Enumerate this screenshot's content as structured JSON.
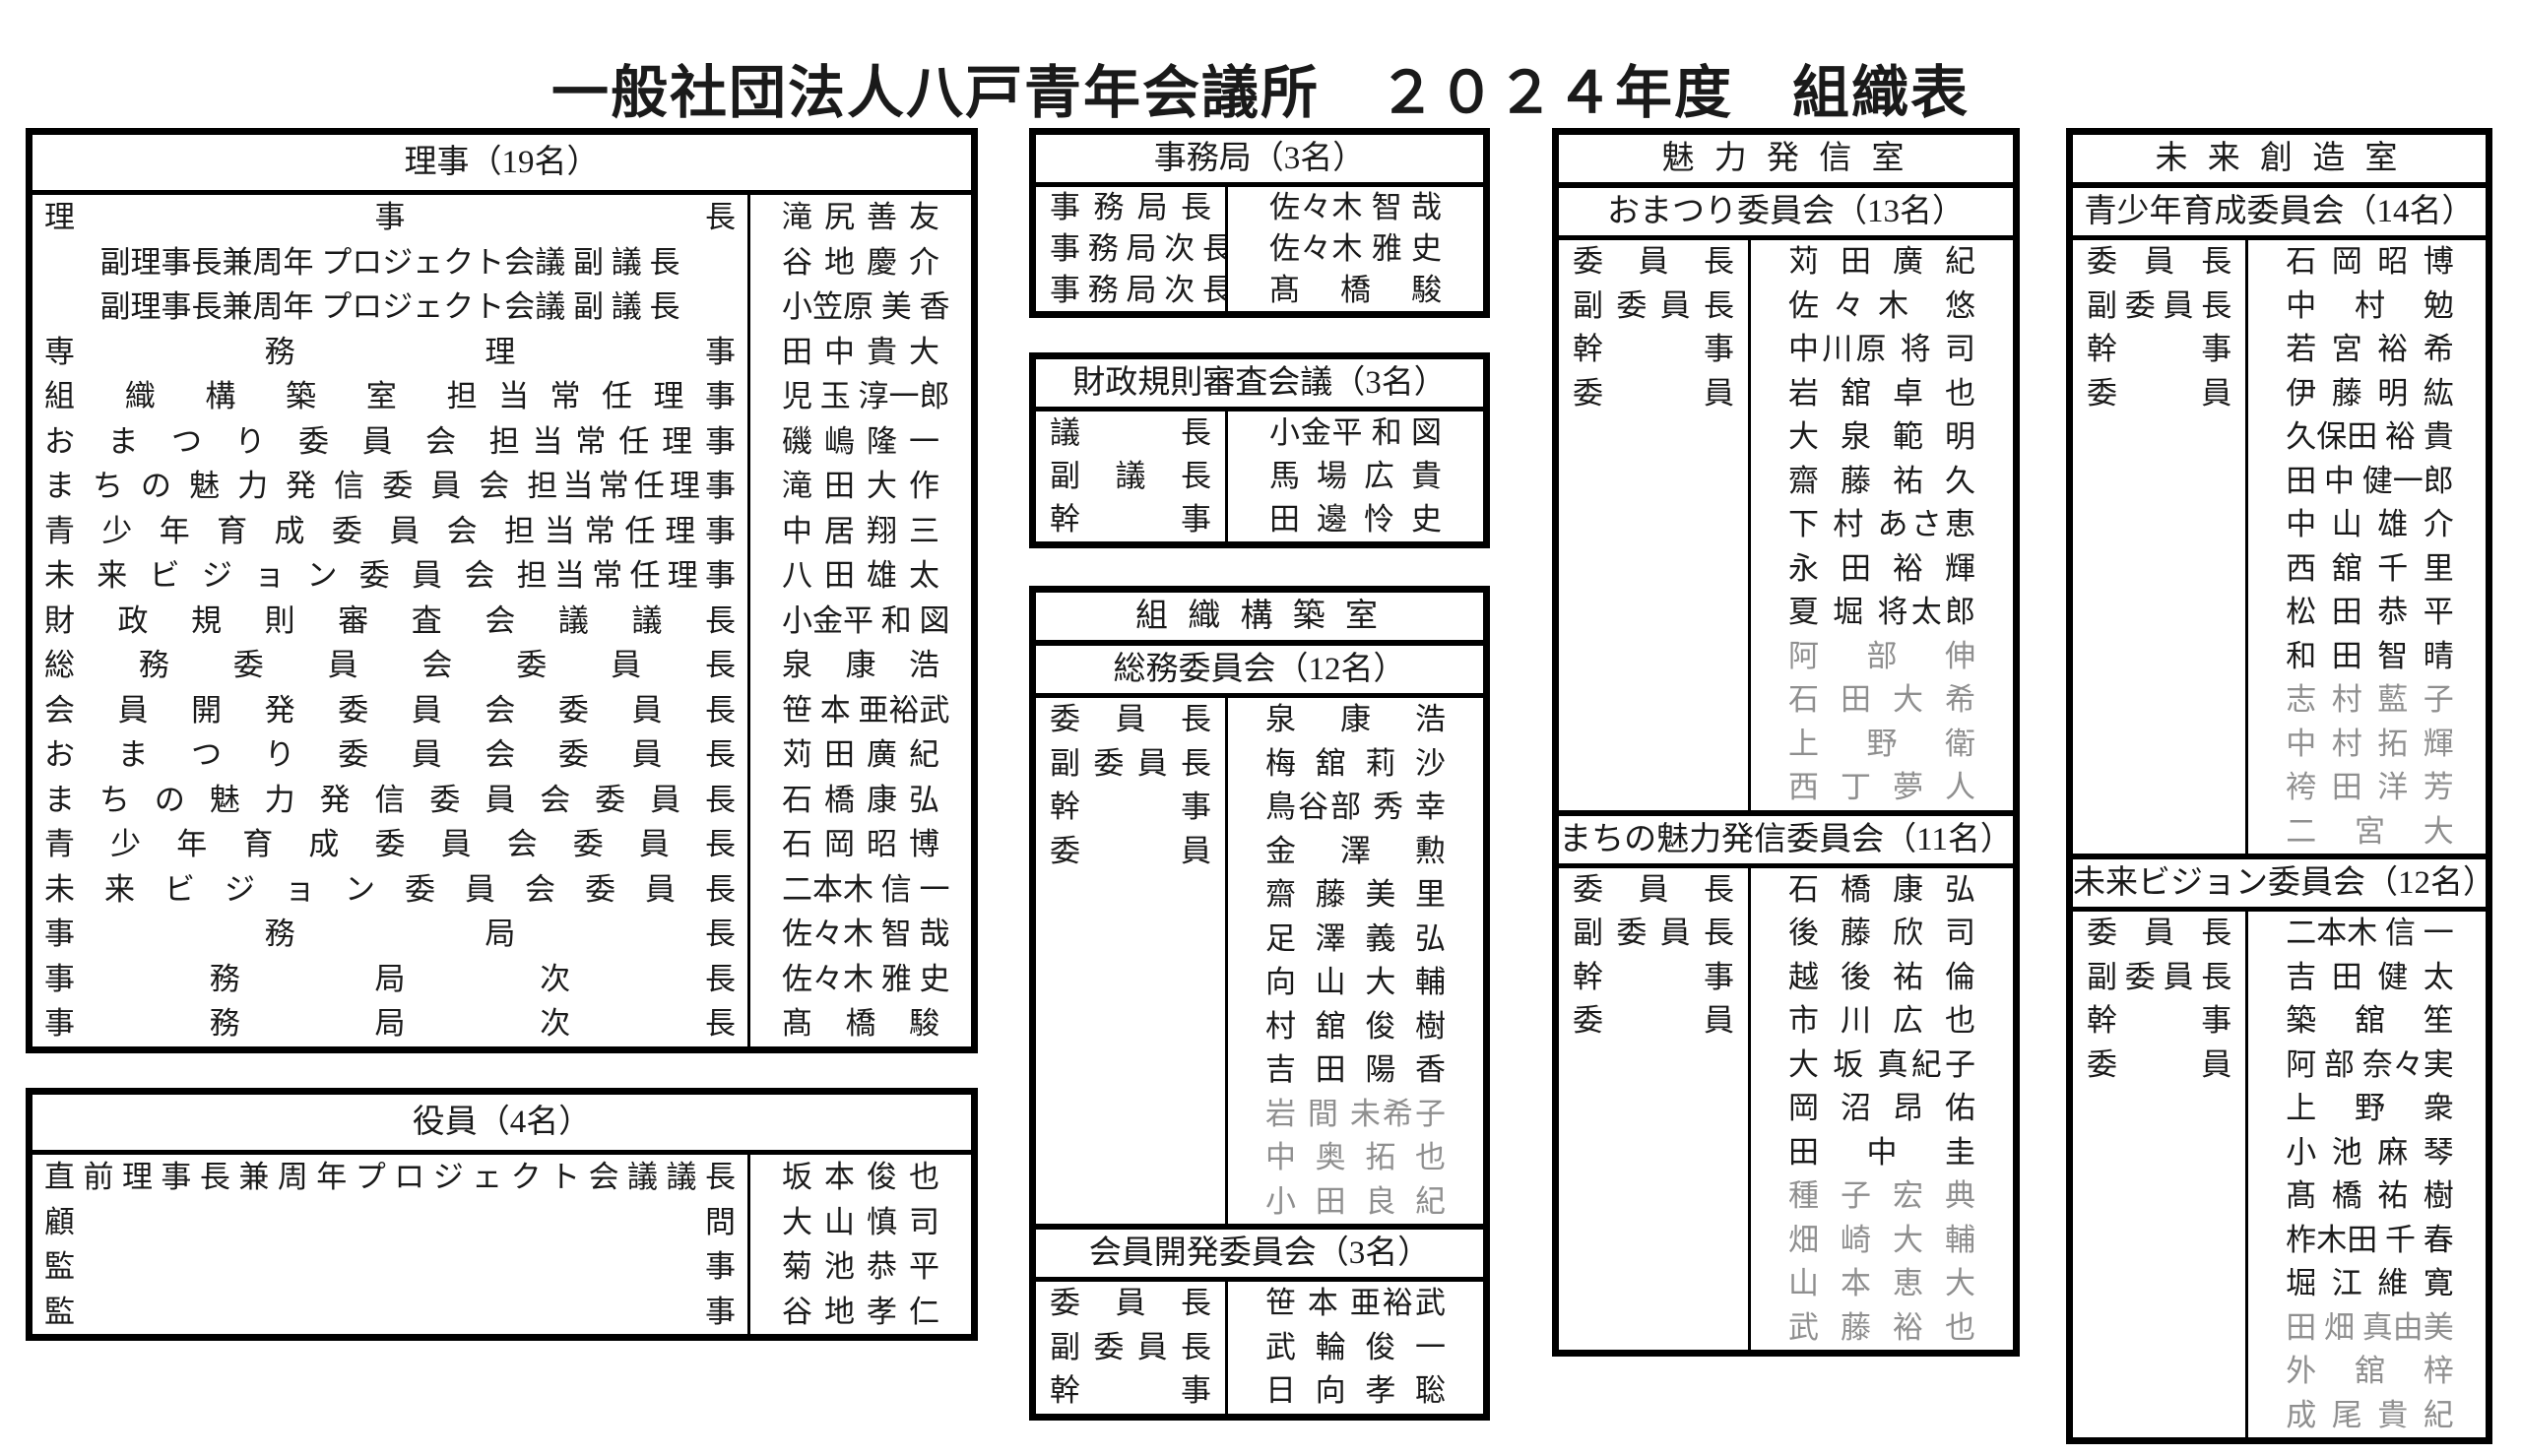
{
  "title": "一般社団法人八戸青年会議所　２０２４年度　組織表",
  "colors": {
    "text": "#1a1a1a",
    "muted_member": "#8f8f8f",
    "border": "#000000",
    "background": "#ffffff"
  },
  "tables": {
    "riji": {
      "header": "理事（19名）",
      "rows": [
        {
          "role": "理 事 長",
          "name": "滝 尻 善 友"
        },
        {
          "role": "副理事長兼周年 プロジェクト会議 副 議 長",
          "align": "center",
          "name": "谷 地 慶 介"
        },
        {
          "role": "副理事長兼周年 プロジェクト会議 副 議 長",
          "align": "center",
          "name": "小笠原 美 香"
        },
        {
          "role": "専 務 理 事",
          "name": "田 中 貴 大"
        },
        {
          "role": "組 織 構 築 室 担当常任理事",
          "name": "児 玉 淳一郎"
        },
        {
          "role": "お ま つ り 委 員 会 担当常任理事",
          "name": "磯 嶋 隆 一"
        },
        {
          "role": "ま ち の 魅 力 発 信 委 員 会 担当常任理事",
          "name": "滝 田 大 作"
        },
        {
          "role": "青 少 年 育 成 委 員 会 担当常任理事",
          "name": "中 居 翔 三"
        },
        {
          "role": "未 来 ビ ジ ョ ン 委 員 会 担当常任理事",
          "name": "八 田 雄 太"
        },
        {
          "role": "財 政 規 則 審 査 会 議 議 長",
          "name": "小金平 和 図"
        },
        {
          "role": "総 務 委 員 会 委 員 長",
          "name": "泉 康 浩"
        },
        {
          "role": "会 員 開 発 委 員 会 委 員 長",
          "name": "笹 本 亜裕武"
        },
        {
          "role": "お ま つ り 委 員 会 委 員 長",
          "name": "苅 田 廣 紀"
        },
        {
          "role": "ま ち の 魅 力 発 信 委 員 会 委 員 長",
          "name": "石 橋 康 弘"
        },
        {
          "role": "青 少 年 育 成 委 員 会 委 員 長",
          "name": "石 岡 昭 博"
        },
        {
          "role": "未 来 ビ ジ ョ ン 委 員 会 委 員 長",
          "name": "二本木 信 一"
        },
        {
          "role": "事 務 局 長",
          "name": "佐々木 智 哉"
        },
        {
          "role": "事 務 局 次 長",
          "name": "佐々木 雅 史"
        },
        {
          "role": "事 務 局 次 長",
          "name": "髙 橋 駿"
        }
      ]
    },
    "yakuin": {
      "header": "役員（4名）",
      "rows": [
        {
          "role": "直 前 理 事 長 兼 周 年 プ ロ ジ ェ ク ト 会 議 議 長",
          "name": "坂 本 俊 也"
        },
        {
          "role": "顧 問",
          "name": "大 山 慎 司"
        },
        {
          "role": "監 事",
          "name": "菊 池 恭 平"
        },
        {
          "role": "監 事",
          "name": "谷 地 孝 仁"
        }
      ]
    },
    "jimukyoku": {
      "header": "事務局（3名）",
      "rows": [
        {
          "role": "事 務 局 長",
          "name": "佐々木 智 哉"
        },
        {
          "role": "事 務 局 次 長",
          "name": "佐々木 雅 史"
        },
        {
          "role": "事 務 局 次 長",
          "name": "髙 橋 駿"
        }
      ]
    },
    "zaisei": {
      "header": "財政規則審査会議（3名）",
      "rows": [
        {
          "role": "議 長",
          "name": "小金平 和 図"
        },
        {
          "role": "副 議 長",
          "name": "馬 場 広 貴"
        },
        {
          "role": "幹 事",
          "name": "田 邊 怜 史"
        }
      ]
    }
  },
  "rooms": [
    {
      "name": "組 織 構 築 室",
      "committees": [
        {
          "header": "総務委員会（12名）",
          "officers": [
            {
              "role": "委 員 長",
              "name": "泉 康 浩"
            },
            {
              "role": "副 委 員 長",
              "name": "梅 舘 莉 沙"
            },
            {
              "role": "幹 事",
              "name": "鳥谷部 秀 幸"
            }
          ],
          "member_label": "委 員",
          "members": [
            {
              "name": "金 澤 勲",
              "muted": false
            },
            {
              "name": "齋 藤 美 里",
              "muted": false
            },
            {
              "name": "足 澤 義 弘",
              "muted": false
            },
            {
              "name": "向 山 大 輔",
              "muted": false
            },
            {
              "name": "村 舘 俊 樹",
              "muted": false
            },
            {
              "name": "吉 田 陽 香",
              "muted": false
            },
            {
              "name": "岩 間 未希子",
              "muted": true
            },
            {
              "name": "中 奥 拓 也",
              "muted": true
            },
            {
              "name": "小 田 良 紀",
              "muted": true
            }
          ]
        },
        {
          "header": "会員開発委員会（3名）",
          "officers": [
            {
              "role": "委 員 長",
              "name": "笹 本 亜裕武"
            },
            {
              "role": "副 委 員 長",
              "name": "武 輪 俊 一"
            },
            {
              "role": "幹 事",
              "name": "日 向 孝 聡"
            }
          ],
          "member_label": "",
          "members": []
        }
      ]
    },
    {
      "name": "魅 力 発 信 室",
      "committees": [
        {
          "header": "おまつり委員会（13名）",
          "officers": [
            {
              "role": "委 員 長",
              "name": "苅 田 廣 紀"
            },
            {
              "role": "副 委 員 長",
              "name": "佐々木 悠"
            },
            {
              "role": "幹 事",
              "name": "中川原 将 司"
            }
          ],
          "member_label": "委 員",
          "members": [
            {
              "name": "岩 舘 卓 也",
              "muted": false
            },
            {
              "name": "大 泉 範 明",
              "muted": false
            },
            {
              "name": "齋 藤 祐 久",
              "muted": false
            },
            {
              "name": "下 村 あさ恵",
              "muted": false
            },
            {
              "name": "永 田 裕 輝",
              "muted": false
            },
            {
              "name": "夏 堀 将太郎",
              "muted": false
            },
            {
              "name": "阿 部 伸",
              "muted": true
            },
            {
              "name": "石 田 大 希",
              "muted": true
            },
            {
              "name": "上 野 衛",
              "muted": true
            },
            {
              "name": "西 丁 夢 人",
              "muted": true
            }
          ]
        },
        {
          "header": "まちの魅力発信委員会（11名）",
          "officers": [
            {
              "role": "委 員 長",
              "name": "石 橋 康 弘"
            },
            {
              "role": "副 委 員 長",
              "name": "後 藤 欣 司"
            },
            {
              "role": "幹 事",
              "name": "越 後 祐 倫"
            }
          ],
          "member_label": "委 員",
          "members": [
            {
              "name": "市 川 広 也",
              "muted": false
            },
            {
              "name": "大 坂 真紀子",
              "muted": false
            },
            {
              "name": "岡 沼 昂 佑",
              "muted": false
            },
            {
              "name": "田 中 圭",
              "muted": false
            },
            {
              "name": "種 子 宏 典",
              "muted": true
            },
            {
              "name": "畑 崎 大 輔",
              "muted": true
            },
            {
              "name": "山 本 恵 大",
              "muted": true
            },
            {
              "name": "武 藤 裕 也",
              "muted": true
            }
          ]
        }
      ]
    },
    {
      "name": "未 来 創 造 室",
      "committees": [
        {
          "header": "青少年育成委員会（14名）",
          "officers": [
            {
              "role": "委 員 長",
              "name": "石 岡 昭 博"
            },
            {
              "role": "副 委 員 長",
              "name": "中 村 勉"
            },
            {
              "role": "幹 事",
              "name": "若 宮 裕 希"
            }
          ],
          "member_label": "委 員",
          "members": [
            {
              "name": "伊 藤 明 紘",
              "muted": false
            },
            {
              "name": "久保田 裕 貴",
              "muted": false
            },
            {
              "name": "田 中 健一郎",
              "muted": false
            },
            {
              "name": "中 山 雄 介",
              "muted": false
            },
            {
              "name": "西 舘 千 里",
              "muted": false
            },
            {
              "name": "松 田 恭 平",
              "muted": false
            },
            {
              "name": "和 田 智 晴",
              "muted": false
            },
            {
              "name": "志 村 藍 子",
              "muted": true
            },
            {
              "name": "中 村 拓 輝",
              "muted": true
            },
            {
              "name": "袴 田 洋 芳",
              "muted": true
            },
            {
              "name": "二 宮 大",
              "muted": true
            }
          ]
        },
        {
          "header": "未来ビジョン委員会（12名）",
          "officers": [
            {
              "role": "委 員 長",
              "name": "二本木 信 一"
            },
            {
              "role": "副 委 員 長",
              "name": "吉 田 健 太"
            },
            {
              "role": "幹 事",
              "name": "築 舘 笙"
            }
          ],
          "member_label": "委 員",
          "members": [
            {
              "name": "阿 部 奈々実",
              "muted": false
            },
            {
              "name": "上 野 衆",
              "muted": false
            },
            {
              "name": "小 池 麻 琴",
              "muted": false
            },
            {
              "name": "髙 橋 祐 樹",
              "muted": false
            },
            {
              "name": "柞木田 千 春",
              "muted": false
            },
            {
              "name": "堀 江 維 寛",
              "muted": false
            },
            {
              "name": "田 畑 真由美",
              "muted": true
            },
            {
              "name": "外 舘 梓",
              "muted": true
            },
            {
              "name": "成 尾 貴 紀",
              "muted": true
            }
          ]
        }
      ]
    }
  ]
}
